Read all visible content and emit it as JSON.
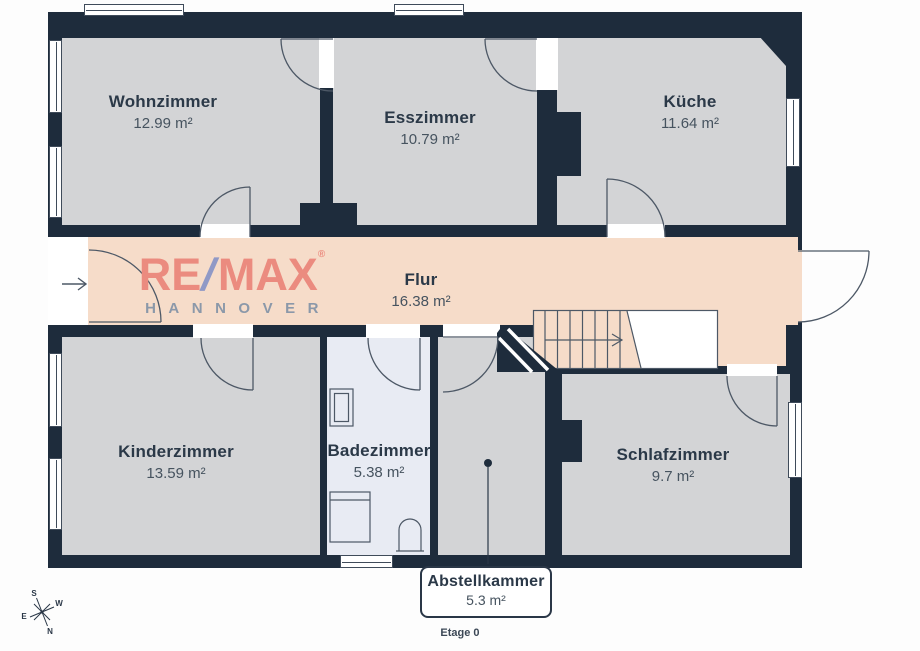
{
  "floorplan": {
    "floor_label": "Etage 0",
    "brand": {
      "re": "RE",
      "slash": "/",
      "max": "MAX",
      "registered": "®",
      "city": "HANNOVER"
    },
    "rooms": [
      {
        "name": "Wohnzimmer",
        "area": "12.99 m²"
      },
      {
        "name": "Esszimmer",
        "area": "10.79 m²"
      },
      {
        "name": "Küche",
        "area": "11.64 m²"
      },
      {
        "name": "Flur",
        "area": "16.38 m²"
      },
      {
        "name": "Kinderzimmer",
        "area": "13.59 m²"
      },
      {
        "name": "Badezimmer",
        "area": "5.38 m²"
      },
      {
        "name": "Schlafzimmer",
        "area": "9.7 m²"
      },
      {
        "name": "Abstellkammer",
        "area": "5.3 m²"
      }
    ],
    "compass": {
      "n": "N",
      "e": "E",
      "s": "S",
      "w": "W"
    },
    "colors": {
      "wall": "#1e2c3c",
      "room_fill": "#d3d4d6",
      "hall_fill": "#f6dcc9",
      "bath_fill": "#e8ebf3",
      "brand_red": "#eb8b7f",
      "brand_blue": "#9099c6"
    }
  }
}
